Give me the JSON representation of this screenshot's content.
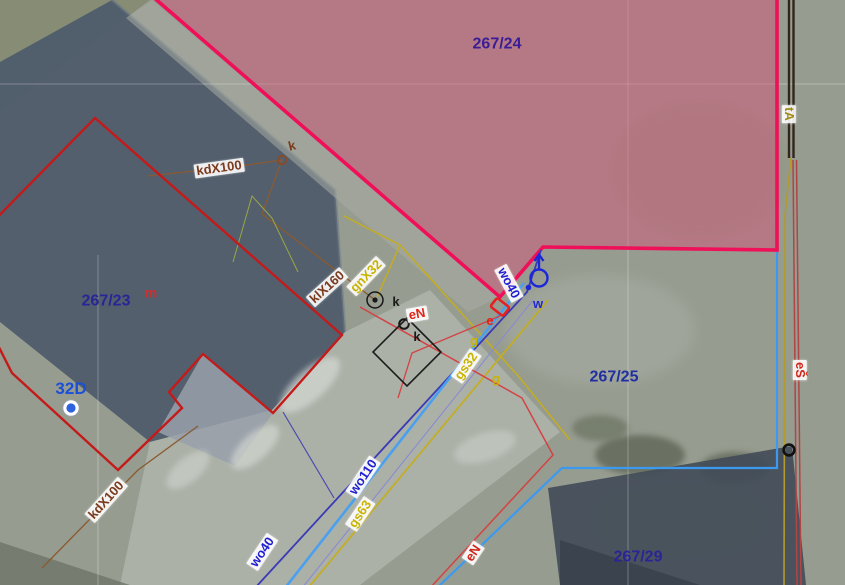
{
  "map": {
    "type": "cadastral-aerial-map-view",
    "highlighted_parcel": "267/24",
    "colors": {
      "highlight_fill": "#dd4978",
      "highlight_boundary": "#ef1059",
      "building_outline": "#c41a1a",
      "parcel_boundary_blue": "#3b9af0",
      "water_line": "#4aa0ee",
      "sewer_line": "#8a5a30",
      "gas_line": "#c4ad1f",
      "electric_line": "#d24343",
      "railway": "#31261c",
      "parcel_text": "#2a2496"
    }
  },
  "labels": [
    {
      "text": "267/24",
      "color": "#3a1d96",
      "kind": "parcel-number"
    },
    {
      "text": "267/23",
      "color": "#2a2496",
      "kind": "parcel-number"
    },
    {
      "text": "267/25",
      "color": "#1f2fa0",
      "kind": "parcel-number"
    },
    {
      "text": "267/29",
      "color": "#2a2496",
      "kind": "parcel-number"
    },
    {
      "text": "m",
      "color": "#cc3030",
      "kind": "point-letter"
    },
    {
      "text": "32D",
      "color": "#1b4fd8",
      "kind": "house-number"
    },
    {
      "text": "kdX100",
      "color": "#7a3a1d",
      "kind": "sewer-label"
    },
    {
      "text": "k",
      "color": "#7a3a1d",
      "kind": "point-letter"
    },
    {
      "text": "klX160",
      "color": "#7a3a1d",
      "kind": "sewer-label"
    },
    {
      "text": "gnX32",
      "color": "#c8b400",
      "kind": "gas-label"
    },
    {
      "text": "k",
      "color": "#1a1a1a",
      "kind": "point-letter"
    },
    {
      "text": "eN",
      "color": "#e02518",
      "kind": "electric-label"
    },
    {
      "text": "k",
      "color": "#1a1a1a",
      "kind": "point-letter"
    },
    {
      "text": "e",
      "color": "#e02518",
      "kind": "point-letter"
    },
    {
      "text": "g",
      "color": "#c8b400",
      "kind": "point-letter"
    },
    {
      "text": "gs32",
      "color": "#c8b400",
      "kind": "gas-label"
    },
    {
      "text": "g",
      "color": "#c8b400",
      "kind": "point-letter"
    },
    {
      "text": "wo40",
      "color": "#1f1fd0",
      "kind": "water-label"
    },
    {
      "text": "w",
      "color": "#1f28d0",
      "kind": "point-letter"
    },
    {
      "text": "tA",
      "color": "#a08c1a",
      "kind": "utility-label"
    },
    {
      "text": "eŠ",
      "color": "#d02518",
      "kind": "electric-label"
    },
    {
      "text": "wo110",
      "color": "#1f1fd0",
      "kind": "water-label"
    },
    {
      "text": "gs63",
      "color": "#c8b400",
      "kind": "gas-label"
    },
    {
      "text": "wo40",
      "color": "#1f1fd0",
      "kind": "water-label"
    },
    {
      "text": "eN",
      "color": "#d02518",
      "kind": "electric-label"
    },
    {
      "text": "kdX100",
      "color": "#7a3a1d",
      "kind": "sewer-label"
    }
  ],
  "symbols": [
    {
      "name": "hydrant-symbol",
      "color": "#1c28d8"
    },
    {
      "name": "house-number-marker",
      "color": "#2e62e0"
    },
    {
      "name": "survey-point-circle-black",
      "color": "#111111"
    },
    {
      "name": "sewer-point-circle",
      "color": "#8a4a26"
    },
    {
      "name": "structure-diamond",
      "color": "#1c1c1c"
    },
    {
      "name": "electric-cabinet",
      "color": "#e42020"
    }
  ]
}
